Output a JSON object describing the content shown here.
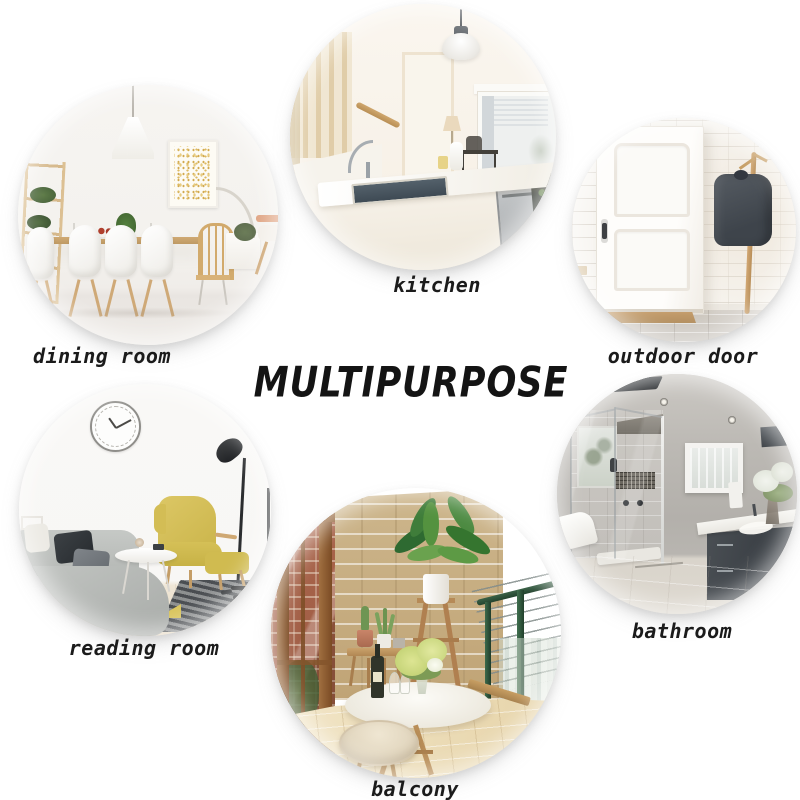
{
  "title": {
    "text": "MULTIPURPOSE"
  },
  "rooms": {
    "dining": {
      "label": "dining room"
    },
    "kitchen": {
      "label": "kitchen"
    },
    "outdoor": {
      "label": "outdoor door"
    },
    "reading": {
      "label": "reading room"
    },
    "balcony": {
      "label": "balcony"
    },
    "bathroom": {
      "label": "bathroom"
    }
  },
  "palette": {
    "background": "#ffffff",
    "label_text": "#1b1b1b",
    "yellow_chair": "#d5c158",
    "stone_wall": "#c8ae80",
    "railing_green": "#2c5a3c",
    "jacket_gray": "#474d54",
    "light_wood": "#c49a62",
    "red_brick": "#a2593e",
    "bath_wall_gray": "#b5b2ad"
  }
}
